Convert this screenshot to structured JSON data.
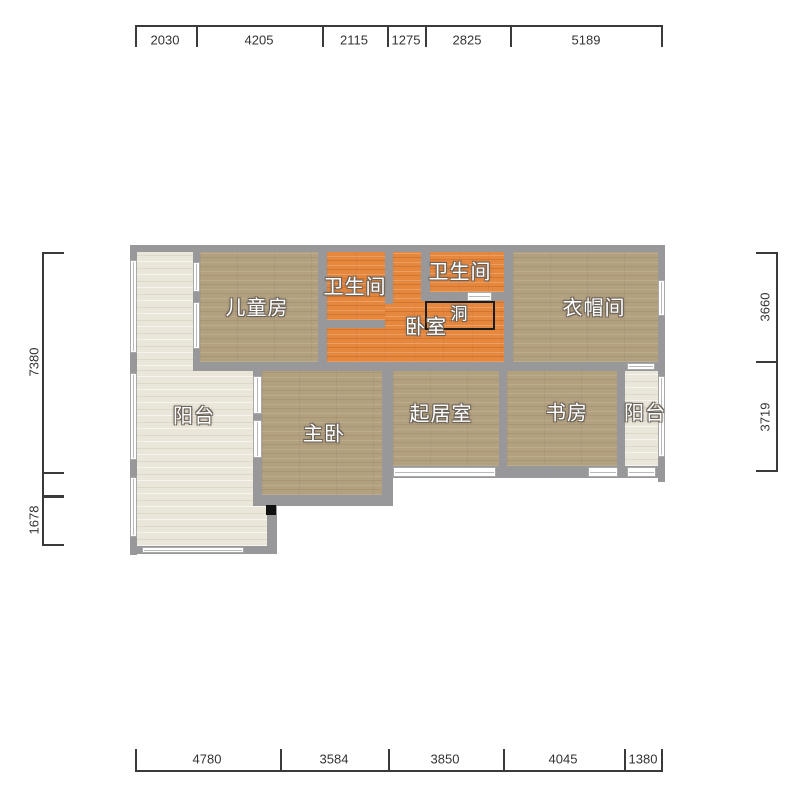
{
  "plan": {
    "rooms": {
      "children_room": "儿童房",
      "bathroom_1": "卫生间",
      "bathroom_2": "卫生间",
      "bedroom": "卧室",
      "opening": "洞",
      "cloakroom": "衣帽间",
      "balcony_left": "阳台",
      "master_bedroom": "主卧",
      "living_room": "起居室",
      "study": "书房",
      "balcony_right": "阳台"
    },
    "colors": {
      "wall": "#98989a",
      "wood_floor": "#b2a07f",
      "orange_floor": "#e6873e",
      "balcony_floor": "#eae6d9",
      "label_text": "#ffffff",
      "label_outline": "#6b6258",
      "dimension_text": "#333333"
    }
  },
  "dimensions": {
    "top": [
      "2030",
      "4205",
      "2115",
      "1275",
      "2825",
      "5189"
    ],
    "bottom": [
      "4780",
      "3584",
      "3850",
      "4045",
      "1380"
    ],
    "left": [
      "7380",
      "1678"
    ],
    "right": [
      "3660",
      "3719"
    ]
  }
}
